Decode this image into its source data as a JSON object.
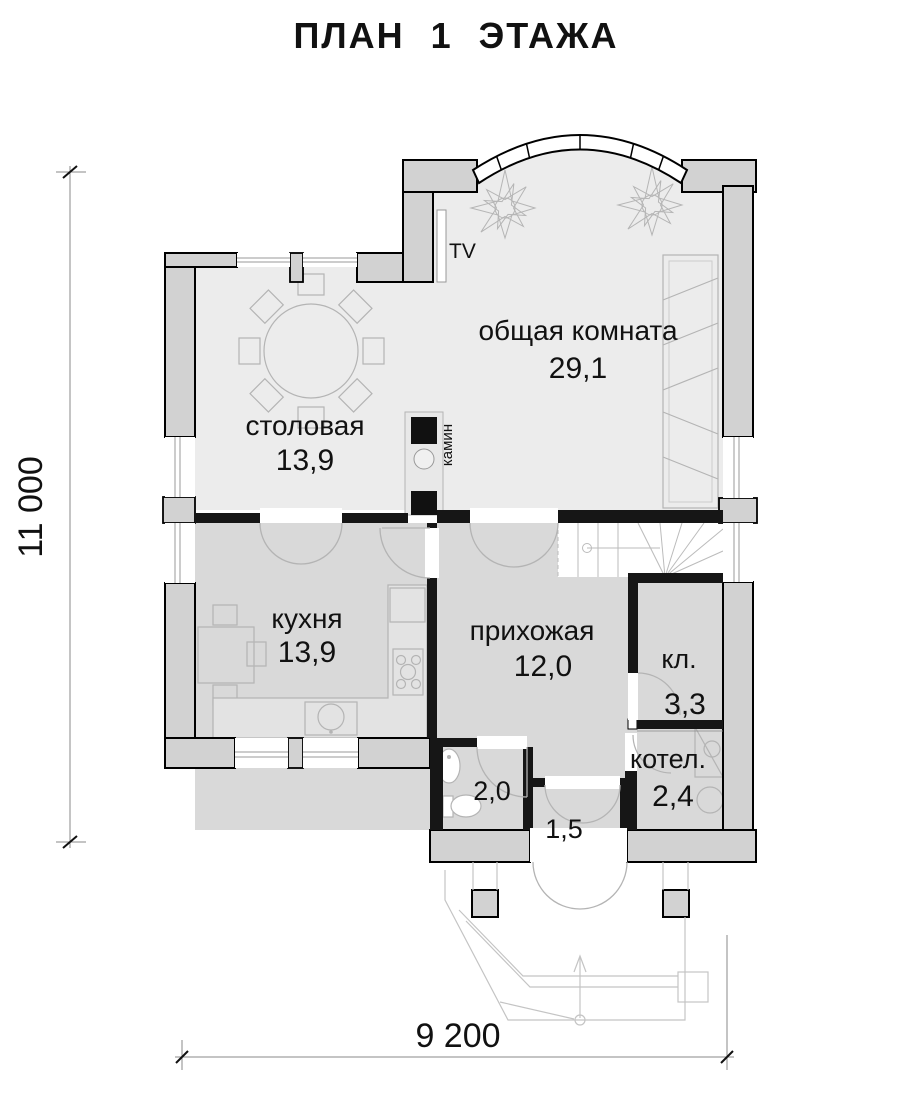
{
  "title": "ПЛАН 1 ЭТАЖА",
  "dimensions": {
    "height": "11 000",
    "width": "9 200"
  },
  "rooms": {
    "living": {
      "name": "общая комната",
      "area": "29,1"
    },
    "dining": {
      "name": "столовая",
      "area": "13,9"
    },
    "kitchen": {
      "name": "кухня",
      "area": "13,9"
    },
    "hall": {
      "name": "прихожая",
      "area": "12,0"
    },
    "closet": {
      "name": "кл.",
      "area": "3,3"
    },
    "boiler": {
      "name": "котел.",
      "area": "2,4"
    },
    "wc": {
      "area": "2,0"
    },
    "vestibule": {
      "area": "1,5"
    }
  },
  "annotations": {
    "tv": "TV",
    "fireplace": "камин"
  }
}
